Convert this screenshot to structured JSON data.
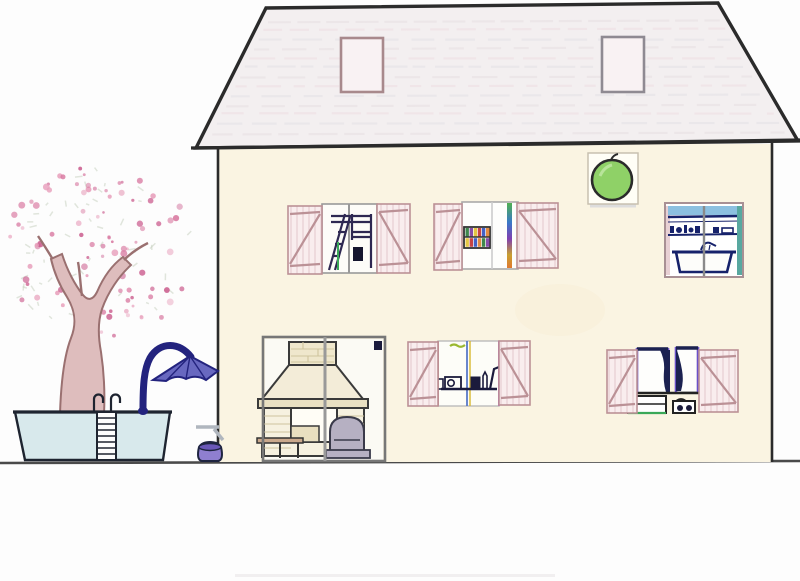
{
  "scene": {
    "description": "hand-drawn colored-pencil elevation of a two-story house with see-through windows, garden tree in blossom, above-ground pool with ladder, and a blue cantilever parasol",
    "objects": [
      "trapezoid roof with two skylights",
      "green round wall lamp in white frame",
      "upper windows: bunk-bed room, bookshelf room, bathroom",
      "lower windows: fireplace lounge patio door, kitchen, bedroom with curtains",
      "blossoming tree",
      "pool with ladder",
      "cantilever parasol",
      "garden tap and pot"
    ]
  },
  "colors": {
    "ink": "#2b2b2b",
    "wall": "#faf4e2",
    "roof": "#f3eff0",
    "skylight_frame": "#a8898c",
    "skylight_fill": "#f9f2f3",
    "shutter_bg": "#f9edee",
    "shutter_stripe": "#e6cdd2",
    "shutter_frame": "#bb9196",
    "frame_gray": "#8a8a8a",
    "navy": "#1b1b3c",
    "bed_ink": "#2e2852",
    "curtain": "#1b2150",
    "purple_frame": "#6a50c8",
    "green": "#3aa858",
    "lamp_green": "#8fd167",
    "sky_blue": "#8cc0e0",
    "bath_ink": "#16226b",
    "teal": "#58a8a0",
    "pool_water": "#d8e9ec",
    "pool_ink": "#1e2430",
    "umbrella": "#6868c0",
    "umbrella_dark": "#23237e",
    "pot": "#8f7fd0",
    "trunk": "#debdbd",
    "trunk_stroke": "#9a7070",
    "brick": "#efe7cc",
    "brick_line": "#cfc49e",
    "fireplace_fill": "#f3ecd8",
    "mantel": "#e9e0c2",
    "chair": "#b6b0c2",
    "bench": "#caa88c",
    "ground": "#4a4a4a"
  },
  "decor": {
    "blossoms": {
      "count": 95,
      "cx": 100,
      "cy": 252,
      "rx": 96,
      "ry": 90,
      "colors": [
        "#d878a0",
        "#cc6090",
        "#e8a0bc"
      ]
    },
    "leaves": {
      "count": 55,
      "color": "#c9d2c2"
    },
    "roof_texture": {
      "lines": 13,
      "colors": [
        "#e8e0e3",
        "#eedde3",
        "#e4e2e6"
      ]
    },
    "bookshelf_books": [
      "#2a7a3a",
      "#7a3aa0",
      "#e0c030",
      "#c03030",
      "#3050c0",
      "#e08030"
    ]
  }
}
